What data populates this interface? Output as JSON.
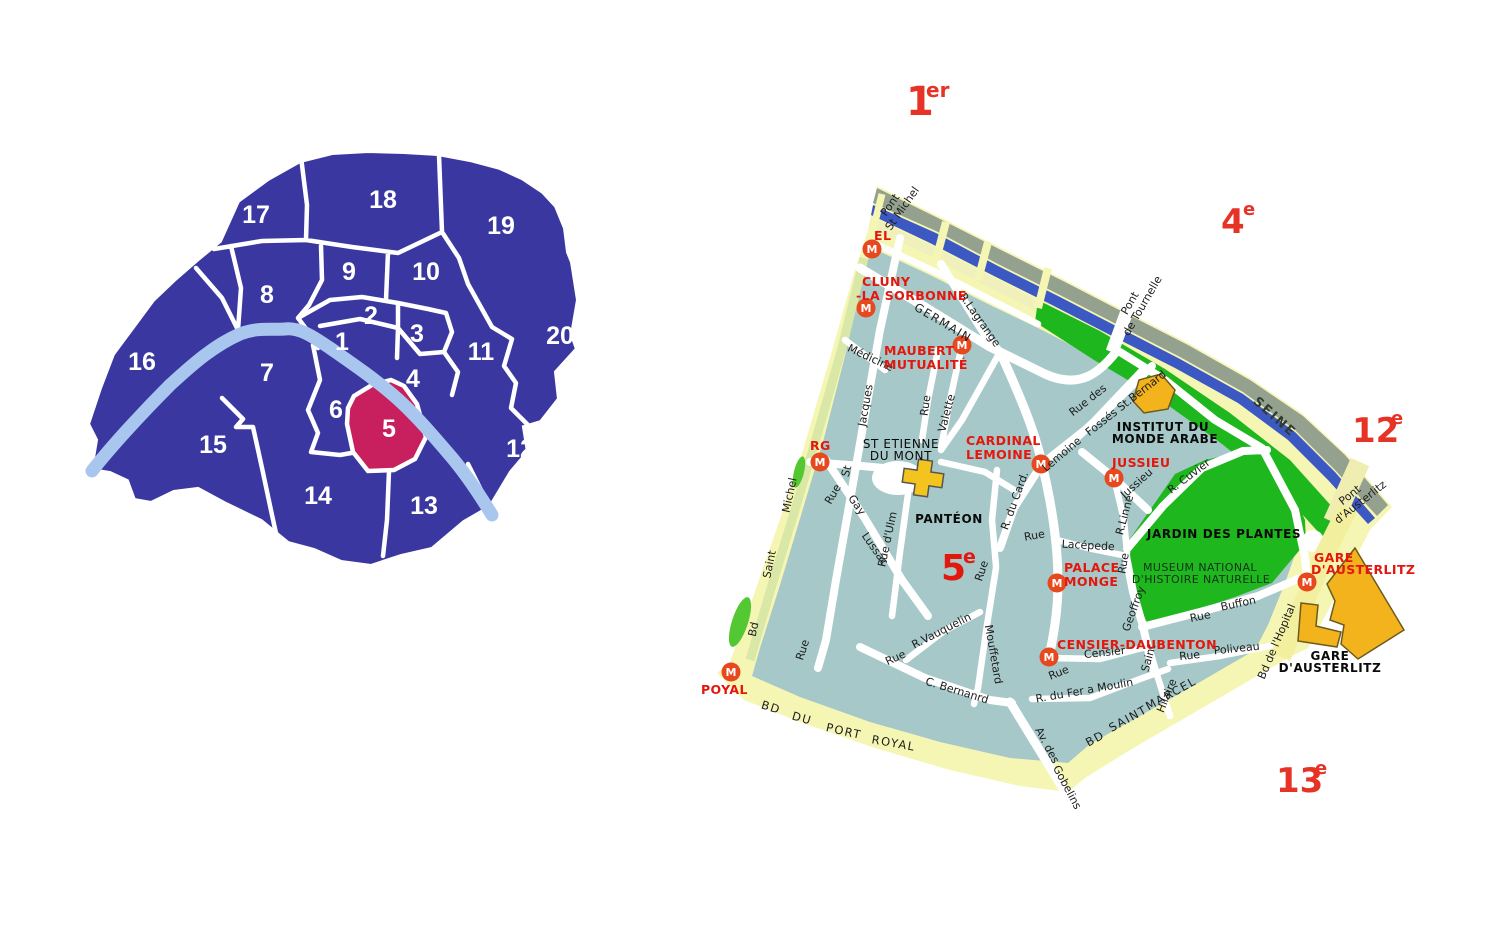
{
  "overview_map": {
    "district_numbers": [
      "1",
      "2",
      "3",
      "4",
      "5",
      "6",
      "7",
      "8",
      "9",
      "10",
      "11",
      "12",
      "13",
      "14",
      "15",
      "16",
      "17",
      "18",
      "19",
      "20"
    ],
    "highlighted_district": "5"
  },
  "detail_map": {
    "metro_m": "M",
    "arrondissements": [
      {
        "n": "1",
        "sup": "er"
      },
      {
        "n": "4",
        "sup": "e"
      },
      {
        "n": "5",
        "sup": "e"
      },
      {
        "n": "12",
        "sup": "e"
      },
      {
        "n": "13",
        "sup": "e"
      }
    ],
    "stations": {
      "st_michel": "EL",
      "cluny_1": "CLUNY",
      "cluny_2": "-LA SORBONNE",
      "maubert_1": "MAUBERT",
      "maubert_2": "MUTUALITÉ",
      "cardinal_1": "CARDINAL",
      "cardinal_2": "LEMOINE",
      "jussieu": "JUSSIEU",
      "monge_1": "PALACE",
      "monge_2": "MONGE",
      "censier": "CENSIER-DAUBENTON",
      "gare_1": "GARE",
      "gare_2": "D'AUSTERLITZ",
      "luxembourg": "RG",
      "port_royal": "POYAL"
    },
    "places": {
      "st_etienne_1": "ST ETIENNE",
      "st_etienne_2": "DU MONT",
      "pantheon": "PANTÉON",
      "institut_1": "INSTITUT DU",
      "institut_2": "MONDE ARABE",
      "jardin": "JARDIN DES PLANTES",
      "museum_1": "MUSEUM NATIONAL",
      "museum_2": "D'HISTOIRE NATURELLE",
      "gare_1": "GARE",
      "gare_2": "D'AUSTERLITZ",
      "seine": "SEINE"
    },
    "bridges": {
      "pont": "Pont",
      "st_michel": "St Michel",
      "de_tournelle": "de Tournelle",
      "austerlitz": "d'Austerlitz"
    },
    "streets": {
      "rue": "Rue",
      "bd": "BD",
      "du": "DU",
      "port": "PORT",
      "royal": "ROYAL",
      "saint_u": "SAINT",
      "marcel": "MARCEL",
      "bd_l": "Bd",
      "saint": "Saint",
      "michel": "Michel",
      "germain": "GERMAIN",
      "lagrange": "R.Lagrange",
      "medicine": "Médicine",
      "jacques": "Jacques",
      "st": "St",
      "valette": "Valette",
      "ulm": "Rue d'Ulm",
      "gay": "Gay",
      "lussac": "Lussac",
      "rue_des": "Rue des",
      "fosses": "Fossés St.Bernard",
      "lemoine": "Lemoine",
      "card": "R. du Card.",
      "jussieu": "Jussieu",
      "linne": "R.Linné",
      "cuvier": "R. Cuvier",
      "lacepede": "Lacépede",
      "geoffroy": "Geoffroy",
      "buffon": "Buffon",
      "censier": "Censier",
      "fer_a_moulin": "R. du Fer a Moulin",
      "hilaire": "Hilaire",
      "poliveau": "Poliveau",
      "mouffetard": "Mouffetard",
      "vauquelin": "R.Vauquelin",
      "c_bernard": "C. Bernanrd",
      "av_des": "Av. des",
      "gobelins": "Gobelins",
      "hopital": "Bd de l'Hopital"
    }
  },
  "colors": {
    "district_blue": "#3a38a0",
    "highlight_pink": "#c81f5e",
    "seine_light_blue": "#a9c6ee",
    "map_teal": "#a6c8c8",
    "band_yellow": "#f6f6b4",
    "quay_gray": "#95a18f",
    "river_blue": "#3c58c3",
    "park_green": "#1eb81e",
    "building_orange": "#f2b31c",
    "metro_red": "#e8481e",
    "label_red": "#e3170d"
  }
}
